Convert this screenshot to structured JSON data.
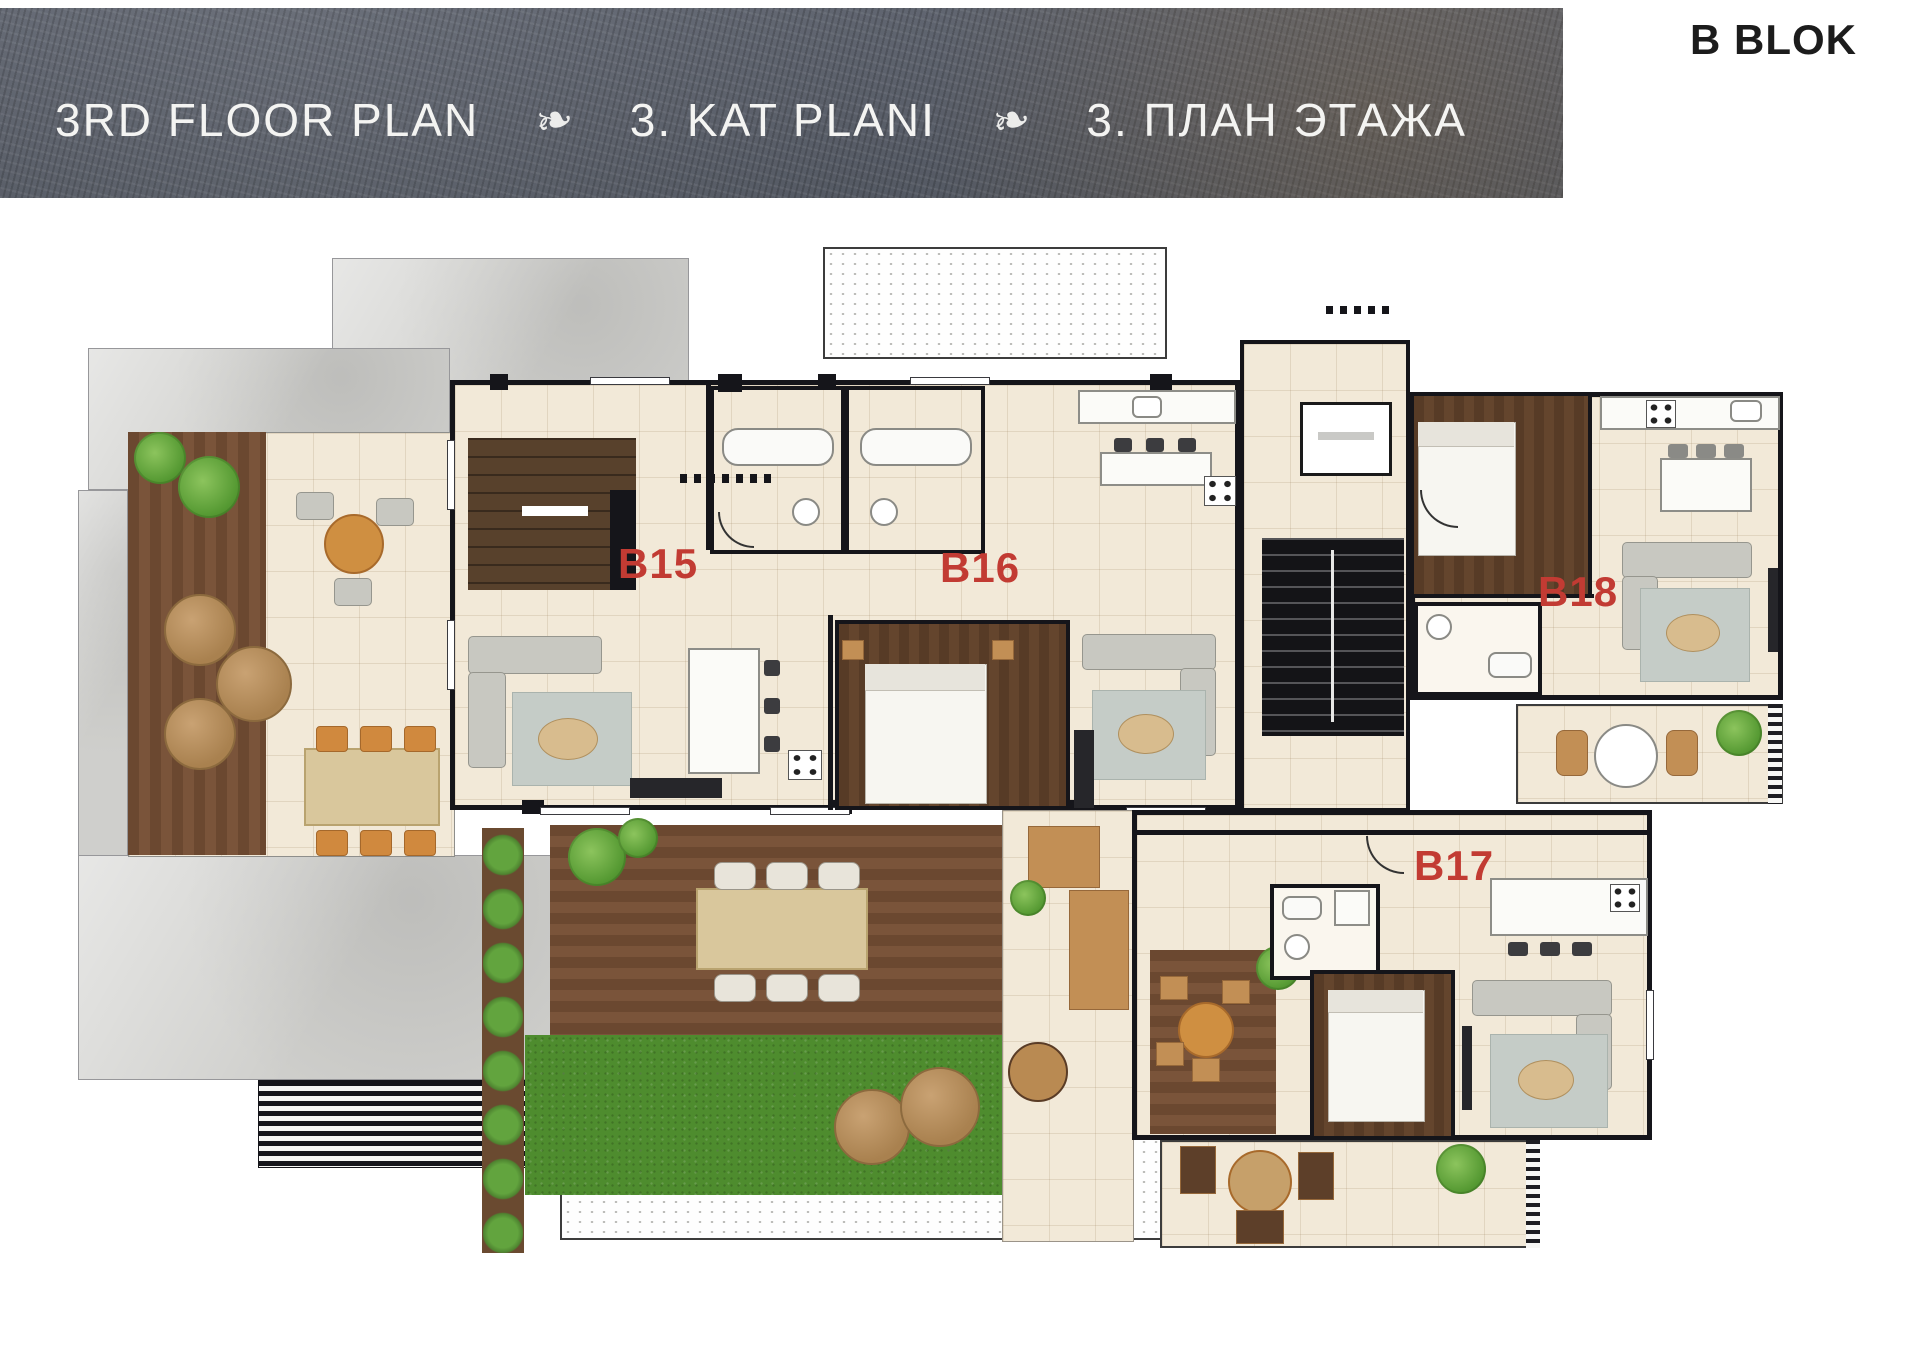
{
  "header": {
    "title_en": "3RD FLOOR PLAN",
    "title_tr": "3. KAT PLANI",
    "title_ru": "3. ПЛАН ЭТАЖА",
    "ornament": "❧",
    "block_label": "B BLOK"
  },
  "units": [
    {
      "id": "B15",
      "label": "B15"
    },
    {
      "id": "B16",
      "label": "B16"
    },
    {
      "id": "B17",
      "label": "B17"
    },
    {
      "id": "B18",
      "label": "B18"
    }
  ],
  "colors": {
    "banner_bg": "#5d626c",
    "banner_text": "#f4f4f2",
    "unit_label": "#c23b33",
    "wall": "#15151a",
    "floor_tile": "#f2e9d8",
    "wood_deck": "#6f4b30",
    "dark_wood_floor": "#5e4029",
    "grass": "#4e8c2e",
    "concrete": "#cdcdca",
    "block_label_text": "#1c1c1c"
  }
}
